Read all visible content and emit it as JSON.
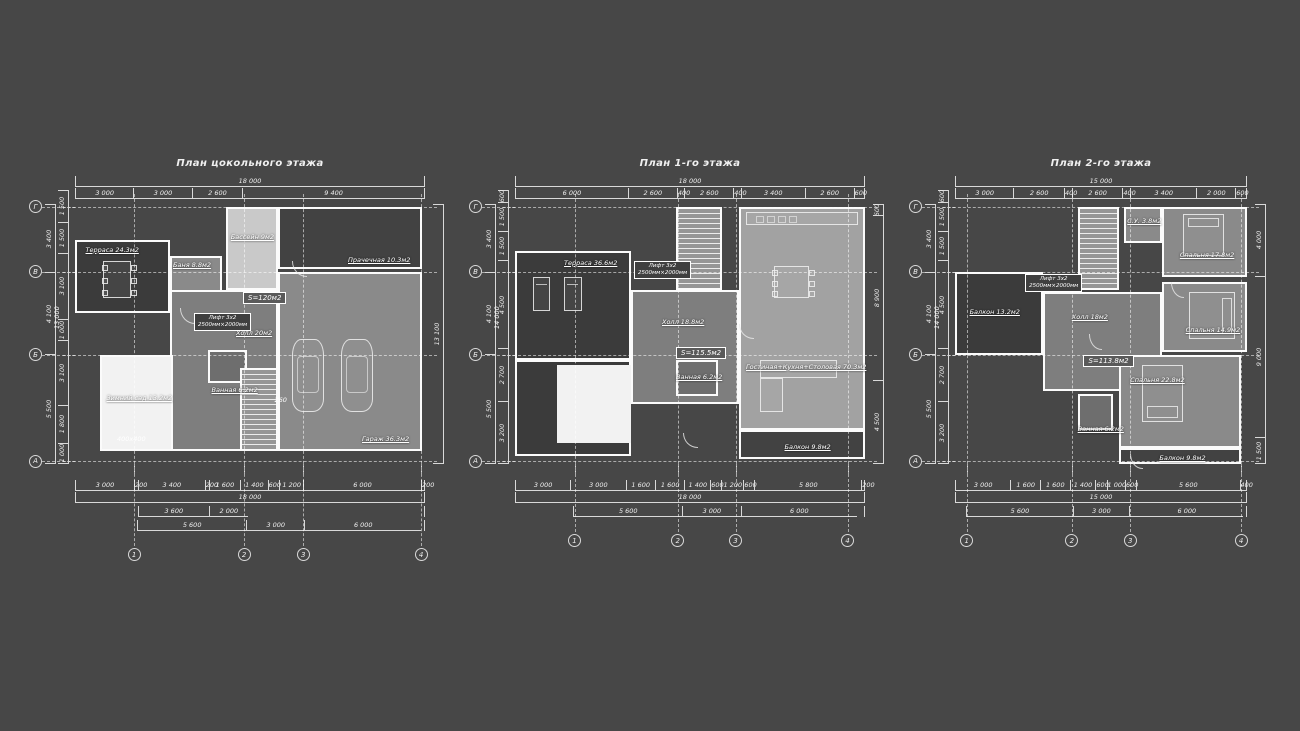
{
  "sheet": {
    "background": "#474747",
    "line_color": "#d9d9d9",
    "text_color": "#eeeeee"
  },
  "fills": {
    "dark": "#3b3b3b",
    "dark2": "#424242",
    "bath": "#6e6e6e",
    "hall": "#7e7e7e",
    "mid": "#8a8a8a",
    "mid2": "#a2a2a2",
    "light": "#c9c9c9",
    "white": "#f2f2f2"
  },
  "plans": [
    {
      "title": "План цокольного этажа",
      "layout": {
        "left": 25,
        "top": 150,
        "bodyX": 50,
        "bodyY": 54,
        "bodyW": 350,
        "bodyH": 260
      },
      "top_overall": "18 000",
      "top_segments": [
        {
          "label": "3 000",
          "v": 3000
        },
        {
          "label": "3 000",
          "v": 3000
        },
        {
          "label": "2 600",
          "v": 2600
        },
        {
          "label": "9 400",
          "v": 9400
        }
      ],
      "bottom_rows": [
        [
          {
            "label": "3 000",
            "v": 3000
          },
          {
            "label": "200",
            "v": 200
          },
          {
            "label": "3 400",
            "v": 3400
          },
          {
            "label": "200",
            "v": 200
          },
          {
            "label": "1 600",
            "v": 1600
          },
          {
            "label": "1 400",
            "v": 1400
          },
          {
            "label": "600",
            "v": 600
          },
          {
            "label": "1 200",
            "v": 1200
          },
          {
            "label": "6 000",
            "v": 6000
          },
          {
            "label": "200",
            "v": 200
          }
        ],
        [
          {
            "label": "18 000",
            "v": 18000
          }
        ],
        [
          {
            "label": "",
            "v": 3200,
            "blank": true
          },
          {
            "label": "3 600",
            "v": 3600
          },
          {
            "label": "2 000",
            "v": 2000
          },
          {
            "label": "",
            "v": 9000,
            "blank": true
          }
        ],
        [
          {
            "label": "",
            "v": 3200,
            "blank": true
          },
          {
            "label": "5 600",
            "v": 5600
          },
          {
            "label": "3 000",
            "v": 3000
          },
          {
            "label": "6 000",
            "v": 6000
          },
          {
            "label": "",
            "v": 200,
            "blank": true
          }
        ]
      ],
      "left_outer": [
        {
          "label": "3 400",
          "v": 3400
        },
        {
          "label": "4 100",
          "v": 4100
        },
        {
          "label": "5 500",
          "v": 5500
        }
      ],
      "left_inner": [
        {
          "label": "1 500",
          "v": 1500
        },
        {
          "label": "1 500",
          "v": 1500
        },
        {
          "label": "3 100",
          "v": 3100
        },
        {
          "label": "1 000",
          "v": 1000
        },
        {
          "label": "3 100",
          "v": 3100
        },
        {
          "label": "1 800",
          "v": 1800
        },
        {
          "label": "1 000",
          "v": 1000
        }
      ],
      "left_overall": "13 000",
      "right_dims": [
        {
          "label": "13 100",
          "v": 13100
        }
      ],
      "axis_numbers": [
        "1",
        "2",
        "3",
        "4"
      ],
      "axis_letters": [
        "Г",
        "В",
        "Б",
        "А"
      ],
      "axes_x": [
        16.9,
        48.3,
        65.2,
        98.9
      ],
      "axes_y": [
        1,
        26,
        58,
        99
      ],
      "rooms": [
        {
          "name": "terrace",
          "fill": "dark",
          "x": 0,
          "y": 14,
          "w": 27,
          "h": 28
        },
        {
          "name": "sauna",
          "fill": "mid",
          "x": 27,
          "y": 20,
          "w": 15,
          "h": 28
        },
        {
          "name": "pool",
          "fill": "light",
          "x": 43,
          "y": 1,
          "w": 15,
          "h": 32
        },
        {
          "name": "laundry",
          "fill": "dark2",
          "x": 58,
          "y": 1,
          "w": 41,
          "h": 24
        },
        {
          "name": "garage",
          "fill": "mid",
          "x": 58,
          "y": 26,
          "w": 41,
          "h": 69
        },
        {
          "name": "hall",
          "fill": "hall",
          "x": 27,
          "y": 33,
          "w": 31,
          "h": 62
        },
        {
          "name": "bathroom",
          "fill": "bath",
          "x": 38,
          "y": 56,
          "w": 11,
          "h": 13
        },
        {
          "name": "winter-garden",
          "fill": "white",
          "x": 7,
          "y": 58,
          "w": 21,
          "h": 37
        }
      ],
      "stairs": {
        "x": 47,
        "y": 63,
        "w": 11,
        "h": 32
      },
      "labels": [
        {
          "text": "Терраса 24.3м2",
          "x": 3,
          "y": 16
        },
        {
          "text": "Баня 8.8м2",
          "x": 28,
          "y": 22
        },
        {
          "text": "Бассейн 9м2",
          "x": 44.5,
          "y": 11
        },
        {
          "text": "Прачечная 10.3м2",
          "x": 78,
          "y": 20
        },
        {
          "text": "Гараж 36.3м2",
          "x": 82,
          "y": 89
        },
        {
          "text": "Холл 20м2",
          "x": 46,
          "y": 48
        },
        {
          "text": "Ванная 6.2м2",
          "x": 39,
          "y": 70
        },
        {
          "text": "Зимний сад 13.2м2",
          "x": 9,
          "y": 73
        }
      ],
      "stamp": {
        "text": "S=120м2",
        "x": 48,
        "y": 34
      },
      "lift": {
        "lines": [
          "Лифт 3х2",
          "2500мм×2000мм"
        ],
        "x": 34,
        "y": 42
      },
      "annotations": [
        {
          "text": "260",
          "x": 57,
          "y": 74
        },
        {
          "text": "400х400",
          "x": 12,
          "y": 89
        }
      ],
      "furniture": [
        {
          "type": "car",
          "x": 62,
          "y": 52,
          "w": 9,
          "h": 28
        },
        {
          "type": "car",
          "x": 76,
          "y": 52,
          "w": 9,
          "h": 28
        },
        {
          "type": "table8",
          "x": 8,
          "y": 22,
          "w": 8,
          "h": 14
        },
        {
          "type": "door",
          "x": 30,
          "y": 40,
          "w": 4,
          "h": 4
        },
        {
          "type": "door",
          "x": 62,
          "y": 22,
          "w": 4,
          "h": 4
        }
      ]
    },
    {
      "title": "План 1-го этажа",
      "layout": {
        "left": 465,
        "top": 150,
        "bodyX": 50,
        "bodyY": 54,
        "bodyW": 350,
        "bodyH": 260
      },
      "top_overall": "18 000",
      "top_segments": [
        {
          "label": "6 000",
          "v": 6000
        },
        {
          "label": "2 600",
          "v": 2600
        },
        {
          "label": "400",
          "v": 400
        },
        {
          "label": "2 600",
          "v": 2600
        },
        {
          "label": "400",
          "v": 400
        },
        {
          "label": "3 400",
          "v": 3400
        },
        {
          "label": "2 600",
          "v": 2600
        },
        {
          "label": "600",
          "v": 600
        }
      ],
      "bottom_rows": [
        [
          {
            "label": "3 000",
            "v": 3000
          },
          {
            "label": "3 000",
            "v": 3000
          },
          {
            "label": "1 600",
            "v": 1600
          },
          {
            "label": "1 600",
            "v": 1600
          },
          {
            "label": "1 400",
            "v": 1400
          },
          {
            "label": "600",
            "v": 600
          },
          {
            "label": "1 200",
            "v": 1200
          },
          {
            "label": "600",
            "v": 600
          },
          {
            "label": "5 800",
            "v": 5800
          },
          {
            "label": "200",
            "v": 200
          }
        ],
        [
          {
            "label": "18 000",
            "v": 18000
          }
        ],
        [
          {
            "label": "",
            "v": 3000,
            "blank": true
          },
          {
            "label": "5 600",
            "v": 5600
          },
          {
            "label": "3 000",
            "v": 3000
          },
          {
            "label": "6 000",
            "v": 6000
          },
          {
            "label": "",
            "v": 400,
            "blank": true
          }
        ]
      ],
      "left_outer": [
        {
          "label": "3 400",
          "v": 3400
        },
        {
          "label": "4 100",
          "v": 4100
        },
        {
          "label": "5 500",
          "v": 5500
        }
      ],
      "left_inner": [
        {
          "label": "600",
          "v": 600
        },
        {
          "label": "1 500",
          "v": 1500
        },
        {
          "label": "1 500",
          "v": 1500
        },
        {
          "label": "4 500",
          "v": 4500
        },
        {
          "label": "2 700",
          "v": 2700
        },
        {
          "label": "3 200",
          "v": 3200
        }
      ],
      "left_overall": "14 000",
      "right_dims": [
        {
          "label": "600",
          "v": 600
        },
        {
          "label": "8 900",
          "v": 8900
        },
        {
          "label": "4 500",
          "v": 4500
        }
      ],
      "axis_numbers": [
        "1",
        "2",
        "3",
        "4"
      ],
      "axis_letters": [
        "Г",
        "В",
        "Б",
        "А"
      ],
      "axes_x": [
        17,
        46.5,
        63,
        95
      ],
      "axes_y": [
        1,
        26,
        58,
        99
      ],
      "rooms": [
        {
          "name": "terrace",
          "fill": "dark",
          "x": 0,
          "y": 18,
          "w": 33,
          "h": 42
        },
        {
          "name": "hall",
          "fill": "hall",
          "x": 33,
          "y": 33,
          "w": 31,
          "h": 44
        },
        {
          "name": "living-kitchen",
          "fill": "mid2",
          "x": 64,
          "y": 1,
          "w": 36,
          "h": 86
        },
        {
          "name": "storage-dark",
          "fill": "dark",
          "x": 0,
          "y": 60,
          "w": 33,
          "h": 37
        },
        {
          "name": "light-well",
          "fill": "white",
          "x": 12,
          "y": 62,
          "w": 21,
          "h": 30,
          "noborder": true
        },
        {
          "name": "bathroom",
          "fill": "bath",
          "x": 46,
          "y": 60,
          "w": 12,
          "h": 14
        },
        {
          "name": "balcony",
          "fill": "dark2",
          "x": 64,
          "y": 87,
          "w": 36,
          "h": 11
        }
      ],
      "stairs": {
        "x": 46,
        "y": 1,
        "w": 13,
        "h": 32
      },
      "labels": [
        {
          "text": "Терраса 36.6м2",
          "x": 14,
          "y": 21
        },
        {
          "text": "Холл 18.8м2",
          "x": 42,
          "y": 44
        },
        {
          "text": "Ванная 6.2м2",
          "x": 46,
          "y": 65
        },
        {
          "text": "Гостиная+Кухня+Столовая 70.3м2",
          "x": 66,
          "y": 61
        },
        {
          "text": "Балкон 9.8м2",
          "x": 77,
          "y": 92
        }
      ],
      "stamp": {
        "text": "S=115.5м2",
        "x": 46,
        "y": 55
      },
      "lift": {
        "lines": [
          "Лифт 3х2",
          "2500мм×2000мм"
        ],
        "x": 34,
        "y": 22
      },
      "annotations": [],
      "furniture": [
        {
          "type": "lounger",
          "x": 5,
          "y": 28,
          "w": 5,
          "h": 13
        },
        {
          "type": "lounger",
          "x": 14,
          "y": 28,
          "w": 5,
          "h": 13
        },
        {
          "type": "kitchen",
          "x": 66,
          "y": 3,
          "w": 32,
          "h": 5
        },
        {
          "type": "table8",
          "x": 74,
          "y": 24,
          "w": 10,
          "h": 12
        },
        {
          "type": "sofa",
          "x": 70,
          "y": 60,
          "w": 22,
          "h": 20
        },
        {
          "type": "door",
          "x": 64,
          "y": 46,
          "w": 4,
          "h": 4
        },
        {
          "type": "door",
          "x": 48,
          "y": 88,
          "w": 4,
          "h": 4
        }
      ]
    },
    {
      "title": "План 2-го этажа",
      "layout": {
        "left": 905,
        "top": 150,
        "bodyX": 50,
        "bodyY": 54,
        "bodyW": 292,
        "bodyH": 260
      },
      "top_overall": "15 000",
      "top_segments": [
        {
          "label": "3 000",
          "v": 3000
        },
        {
          "label": "2 600",
          "v": 2600
        },
        {
          "label": "400",
          "v": 400
        },
        {
          "label": "2 600",
          "v": 2600
        },
        {
          "label": "400",
          "v": 400
        },
        {
          "label": "3 400",
          "v": 3400
        },
        {
          "label": "2 000",
          "v": 2000
        },
        {
          "label": "600",
          "v": 600
        }
      ],
      "bottom_rows": [
        [
          {
            "label": "3 000",
            "v": 3000
          },
          {
            "label": "1 600",
            "v": 1600
          },
          {
            "label": "1 600",
            "v": 1600
          },
          {
            "label": "1 400",
            "v": 1400
          },
          {
            "label": "600",
            "v": 600
          },
          {
            "label": "1 000",
            "v": 1000
          },
          {
            "label": "600",
            "v": 600
          },
          {
            "label": "5 600",
            "v": 5600
          },
          {
            "label": "400",
            "v": 400
          }
        ],
        [
          {
            "label": "15 000",
            "v": 15000
          }
        ],
        [
          {
            "label": "",
            "v": 600,
            "blank": true
          },
          {
            "label": "5 600",
            "v": 5600
          },
          {
            "label": "3 000",
            "v": 3000
          },
          {
            "label": "6 000",
            "v": 6000
          },
          {
            "label": "",
            "v": 200,
            "blank": true
          }
        ]
      ],
      "left_outer": [
        {
          "label": "3 400",
          "v": 3400
        },
        {
          "label": "4 100",
          "v": 4100
        },
        {
          "label": "5 500",
          "v": 5500
        }
      ],
      "left_inner": [
        {
          "label": "600",
          "v": 600
        },
        {
          "label": "1 500",
          "v": 1500
        },
        {
          "label": "1 500",
          "v": 1500
        },
        {
          "label": "4 500",
          "v": 4500
        },
        {
          "label": "2 700",
          "v": 2700
        },
        {
          "label": "3 200",
          "v": 3200
        }
      ],
      "left_overall": "14 000",
      "right_dims": [
        {
          "label": "4 000",
          "v": 4000
        },
        {
          "label": "9 000",
          "v": 9000
        },
        {
          "label": "1 500",
          "v": 1500
        }
      ],
      "axis_numbers": [
        "1",
        "2",
        "3",
        "4"
      ],
      "axis_letters": [
        "Г",
        "В",
        "Б",
        "А"
      ],
      "axes_x": [
        4,
        40,
        60,
        98
      ],
      "axes_y": [
        1,
        26,
        58,
        99
      ],
      "rooms": [
        {
          "name": "balcony-left",
          "fill": "dark",
          "x": 0,
          "y": 26,
          "w": 30,
          "h": 32
        },
        {
          "name": "wc",
          "fill": "mid",
          "x": 58,
          "y": 1,
          "w": 13,
          "h": 14
        },
        {
          "name": "bedroom-1",
          "fill": "mid",
          "x": 71,
          "y": 1,
          "w": 29,
          "h": 27
        },
        {
          "name": "bedroom-2",
          "fill": "mid",
          "x": 71,
          "y": 30,
          "w": 29,
          "h": 27
        },
        {
          "name": "hall",
          "fill": "hall",
          "x": 30,
          "y": 34,
          "w": 41,
          "h": 38
        },
        {
          "name": "bathroom",
          "fill": "bath",
          "x": 42,
          "y": 73,
          "w": 12,
          "h": 14
        },
        {
          "name": "bedroom-3",
          "fill": "mid",
          "x": 56,
          "y": 58,
          "w": 42,
          "h": 36
        },
        {
          "name": "balcony-bottom",
          "fill": "dark2",
          "x": 56,
          "y": 94,
          "w": 42,
          "h": 6
        }
      ],
      "stairs": {
        "x": 42,
        "y": 1,
        "w": 14,
        "h": 32
      },
      "labels": [
        {
          "text": "Балкон 13.2м2",
          "x": 5,
          "y": 40
        },
        {
          "text": "С.У. 3.8м2",
          "x": 59,
          "y": 5
        },
        {
          "text": "Спальня 17.8м2",
          "x": 77,
          "y": 18
        },
        {
          "text": "Спальня 14.9м2",
          "x": 79,
          "y": 47
        },
        {
          "text": "Холл 18м2",
          "x": 40,
          "y": 42
        },
        {
          "text": "Ванная 6.2м2",
          "x": 42,
          "y": 85
        },
        {
          "text": "Спальня 22.8м2",
          "x": 60,
          "y": 66
        },
        {
          "text": "Балкон 9.8м2",
          "x": 70,
          "y": 96
        }
      ],
      "stamp": {
        "text": "S=113.8м2",
        "x": 44,
        "y": 58
      },
      "lift": {
        "lines": [
          "Лифт 3х2",
          "2500мм×2000мм"
        ],
        "x": 24,
        "y": 27
      },
      "annotations": [],
      "furniture": [
        {
          "type": "bed-top",
          "x": 78,
          "y": 4,
          "w": 14,
          "h": 16
        },
        {
          "type": "bed-right",
          "x": 80,
          "y": 34,
          "w": 16,
          "h": 18
        },
        {
          "type": "bed-bottom",
          "x": 64,
          "y": 62,
          "w": 14,
          "h": 22
        },
        {
          "type": "door",
          "x": 46,
          "y": 50,
          "w": 4,
          "h": 4
        },
        {
          "type": "door",
          "x": 74,
          "y": 30,
          "w": 4,
          "h": 4
        },
        {
          "type": "door",
          "x": 60,
          "y": 96,
          "w": 4,
          "h": 4
        }
      ]
    }
  ]
}
